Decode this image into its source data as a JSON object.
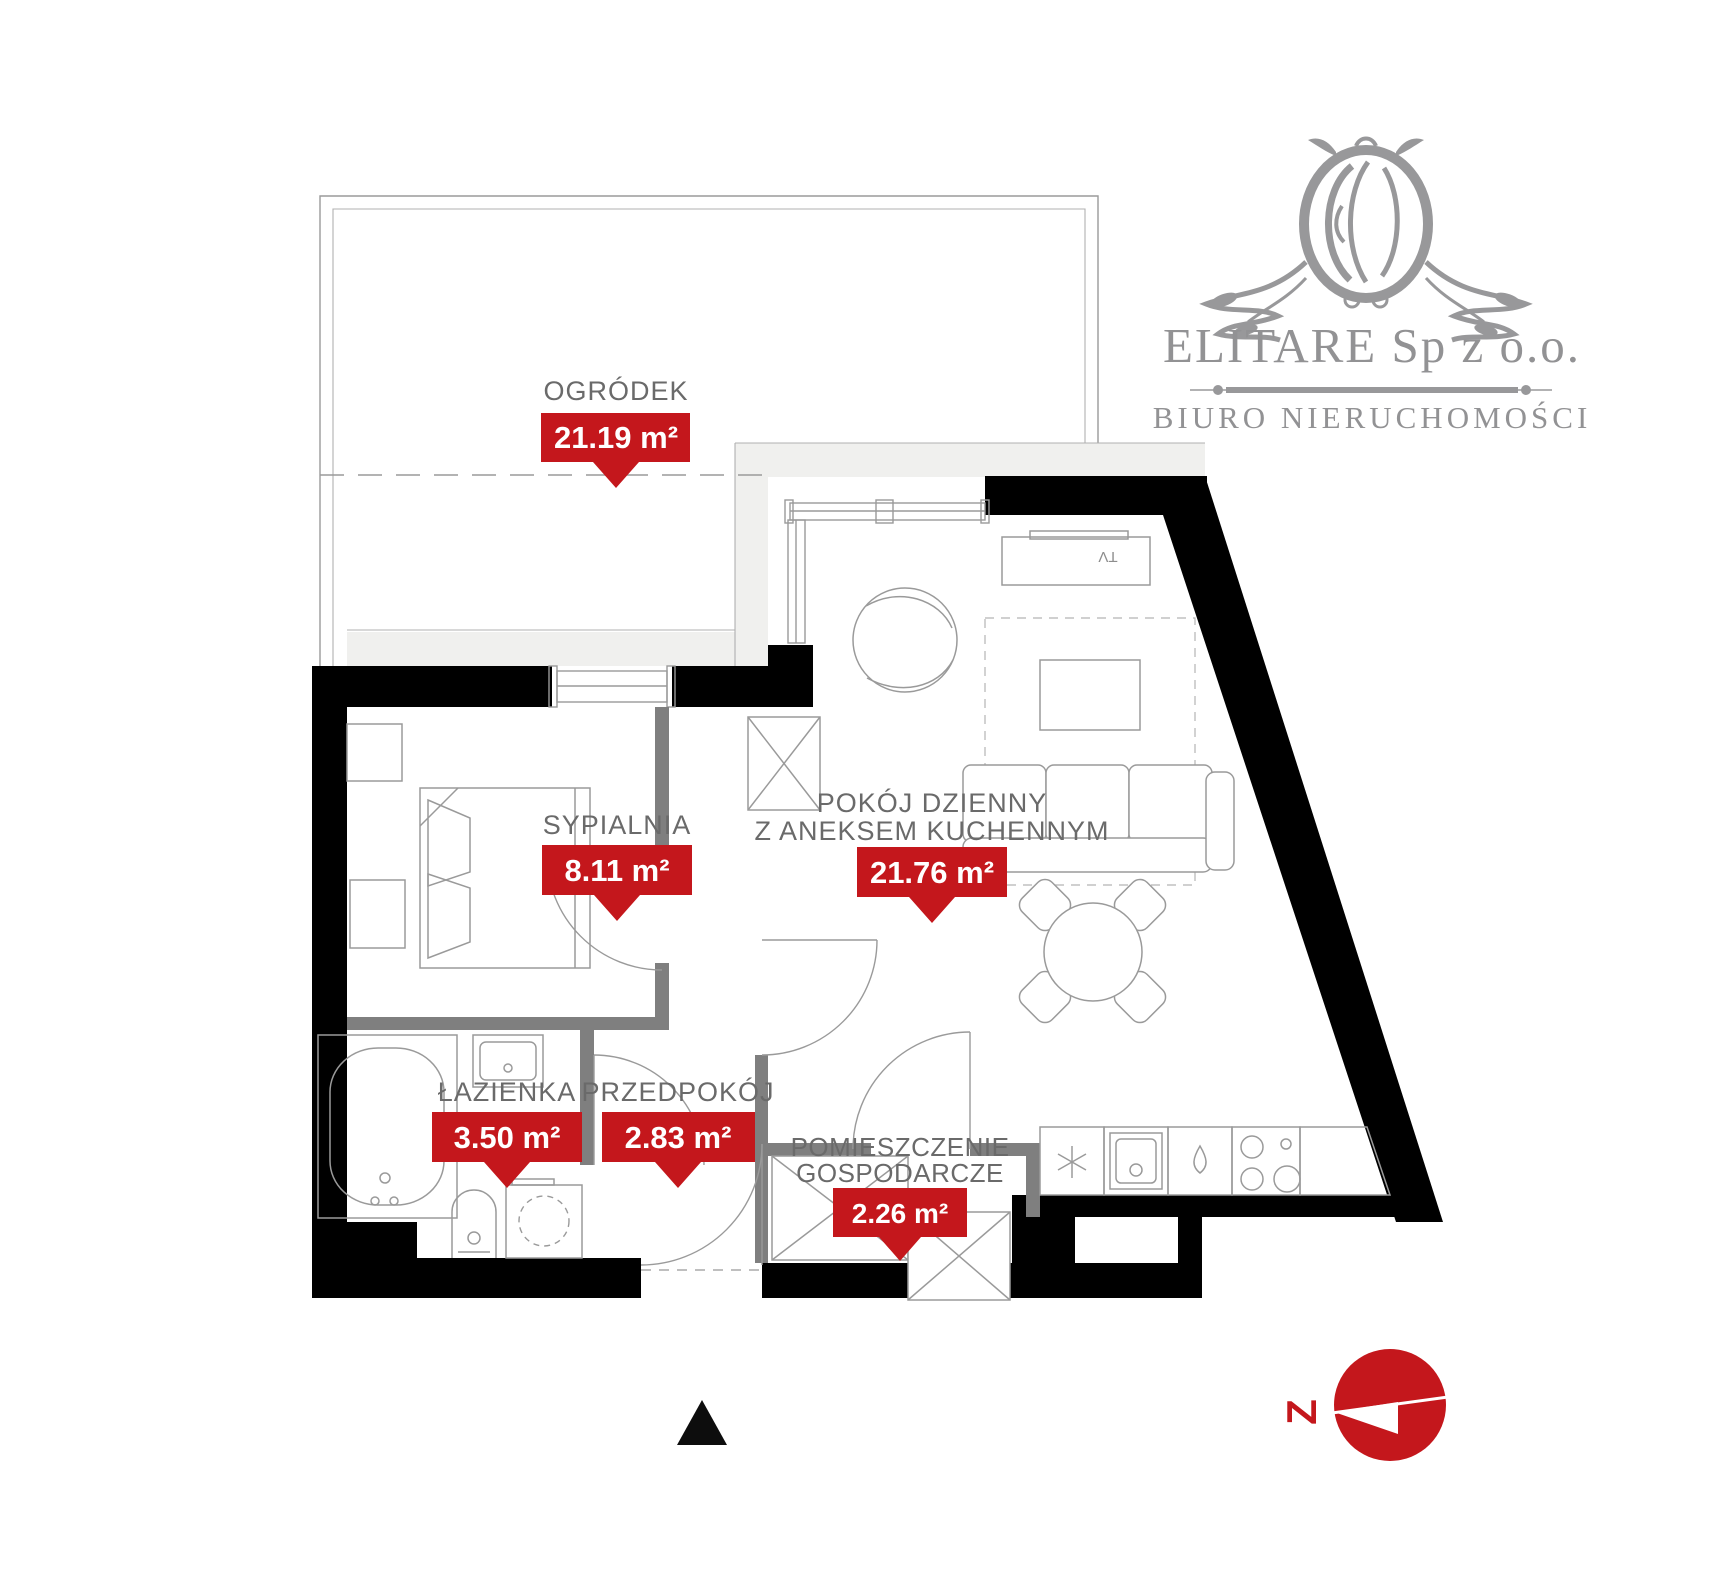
{
  "branding": {
    "company": "ELITARE Sp z o.o.",
    "subtitle": "BIURO NIERUCHOMOŚCI",
    "logo_icon": "lion-ornament-icon",
    "color": "#929294"
  },
  "colors": {
    "accent_red": "#c4171c",
    "wall_black": "#000000",
    "partition_gray": "#7f7f7f",
    "line_gray": "#9a9a9a",
    "label_text_gray": "#6a6a6a"
  },
  "rooms": [
    {
      "id": "ogrodek",
      "name": "OGRÓDEK",
      "name2": "",
      "area": "21.19 m²"
    },
    {
      "id": "sypialnia",
      "name": "SYPIALNIA",
      "name2": "",
      "area": "8.11 m²"
    },
    {
      "id": "pokoj-dzienny",
      "name": "POKÓJ DZIENNY",
      "name2": "Z ANEKSEM KUCHENNYM",
      "area": "21.76 m²"
    },
    {
      "id": "lazienka",
      "name": "ŁAZIENKA",
      "name2": "",
      "area": "3.50 m²"
    },
    {
      "id": "przedpokoj",
      "name": "PRZEDPOKÓJ",
      "name2": "",
      "area": "2.83 m²"
    },
    {
      "id": "pom-gospodarcze",
      "name": "POMIESZCZENIE",
      "name2": "GOSPODARCZE",
      "area": "2.26 m²"
    }
  ],
  "furniture": {
    "tv_label": "TV"
  },
  "compass": {
    "letter": "Z",
    "direction_meaning": "west"
  }
}
